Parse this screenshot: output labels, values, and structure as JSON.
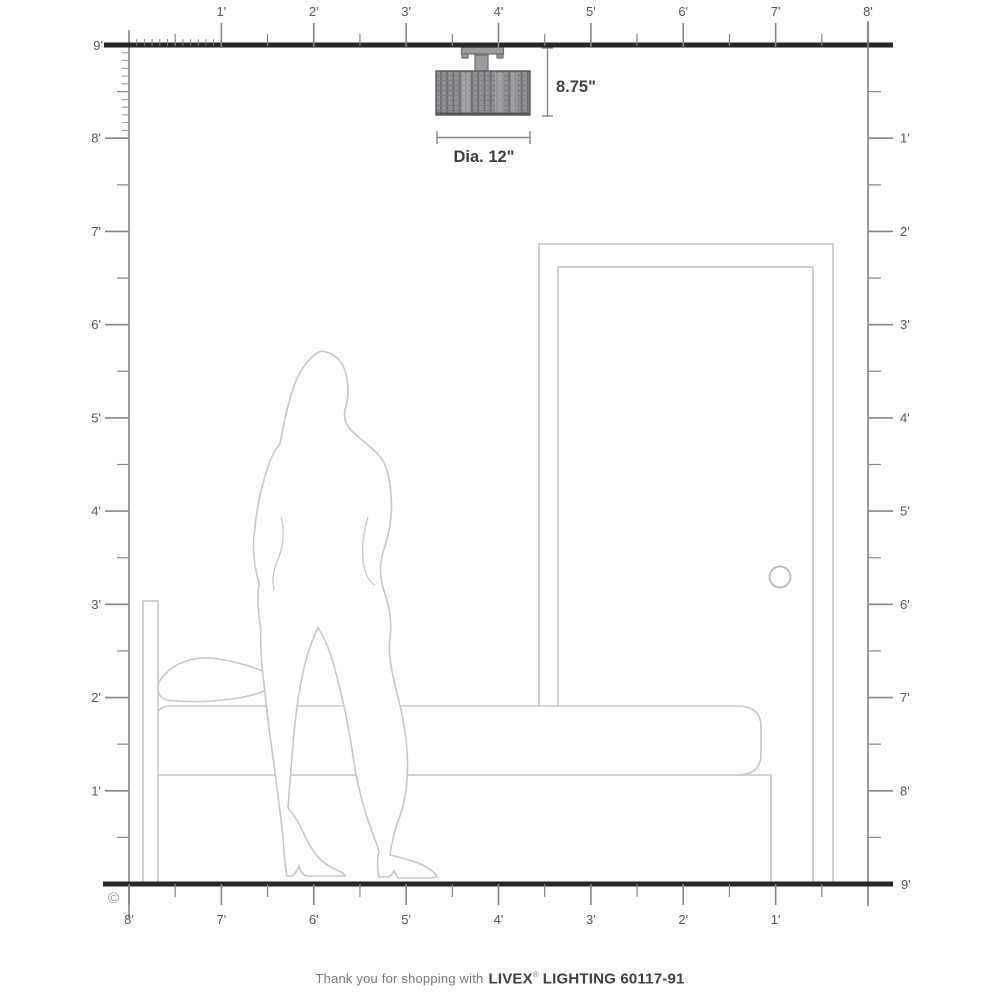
{
  "meta": {
    "copyright": "©"
  },
  "rulers": {
    "top": {
      "labels": [
        "1'",
        "2'",
        "3'",
        "4'",
        "5'",
        "6'",
        "7'",
        "8'"
      ]
    },
    "bottom": {
      "labels": [
        "8'",
        "7'",
        "6'",
        "5'",
        "4'",
        "3'",
        "2'",
        "1'"
      ]
    },
    "left": {
      "corner_label": "9'",
      "labels": [
        "8'",
        "7'",
        "6'",
        "5'",
        "4'",
        "3'",
        "2'",
        "1'"
      ]
    },
    "right": {
      "corner_label": "9'",
      "labels": [
        "1'",
        "2'",
        "3'",
        "4'",
        "5'",
        "6'",
        "7'",
        "8'"
      ]
    }
  },
  "fixture": {
    "height_label": "8.75\"",
    "diameter_label": "Dia. 12\""
  },
  "caption": {
    "prefix": "Thank you for shopping with",
    "brand": "LIVEX",
    "registered": "®",
    "suffix": "LIGHTING 60117-91"
  },
  "colors": {
    "wall": "#29262a",
    "ruler": "#9a9c9f",
    "tick": "#85878a",
    "label": "#55575a",
    "line": "#c6c7c9",
    "dim": "#3f4042",
    "muted": "#919396",
    "caption_gray": "#77787b",
    "caption_dark": "#3f4042"
  }
}
